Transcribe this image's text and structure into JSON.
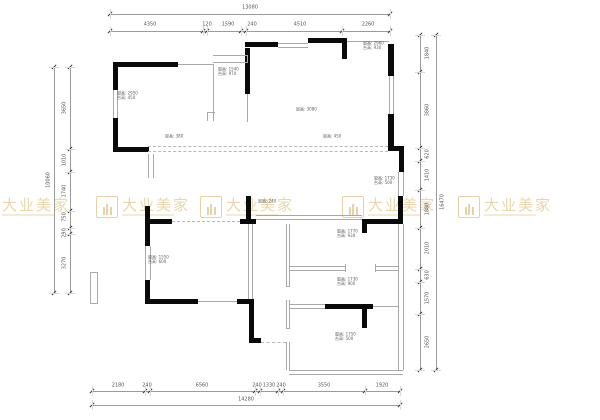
{
  "watermark": {
    "name": "大业美家",
    "color": "#e9d4a9"
  },
  "dimensions": {
    "top": {
      "total": "13080",
      "segments": [
        "4350",
        "120",
        "1590",
        "240",
        "4510",
        "2260"
      ]
    },
    "bottom": {
      "total": "14280",
      "segments": [
        "2180",
        "240",
        "6560",
        "240",
        "1330",
        "240",
        "3550",
        "1920"
      ]
    },
    "left": {
      "total": "10060",
      "segments": [
        "3650",
        "1010",
        "1740",
        "750",
        "290",
        "3270"
      ]
    },
    "right": {
      "total": "16470",
      "segments": [
        "1840",
        "3860",
        "620",
        "1410",
        "1880",
        "2010",
        "630",
        "1570",
        "2650"
      ]
    }
  },
  "annotations": [
    {
      "lines": [
        "窗高: 2960",
        "台高: 930"
      ]
    },
    {
      "lines": [
        "窗高: 1540",
        "台高: 970"
      ]
    },
    {
      "lines": [
        "窗高: 2950",
        "台高: 450"
      ]
    },
    {
      "lines": [
        "梁高: 380"
      ]
    },
    {
      "lines": [
        "层高: 3080"
      ]
    },
    {
      "lines": [
        "梁高: 450"
      ]
    },
    {
      "lines": [
        "窗高: 1730",
        "台高: 500"
      ]
    },
    {
      "lines": [
        "梁高: 240"
      ]
    },
    {
      "lines": [
        "窗高: 1550",
        "台高: 600"
      ]
    },
    {
      "lines": [
        "窗高: 1770",
        "台高: 930"
      ]
    },
    {
      "lines": [
        "窗高: 1730",
        "台高: 900"
      ]
    },
    {
      "lines": [
        "窗高: 1750",
        "台高: 500"
      ]
    }
  ]
}
